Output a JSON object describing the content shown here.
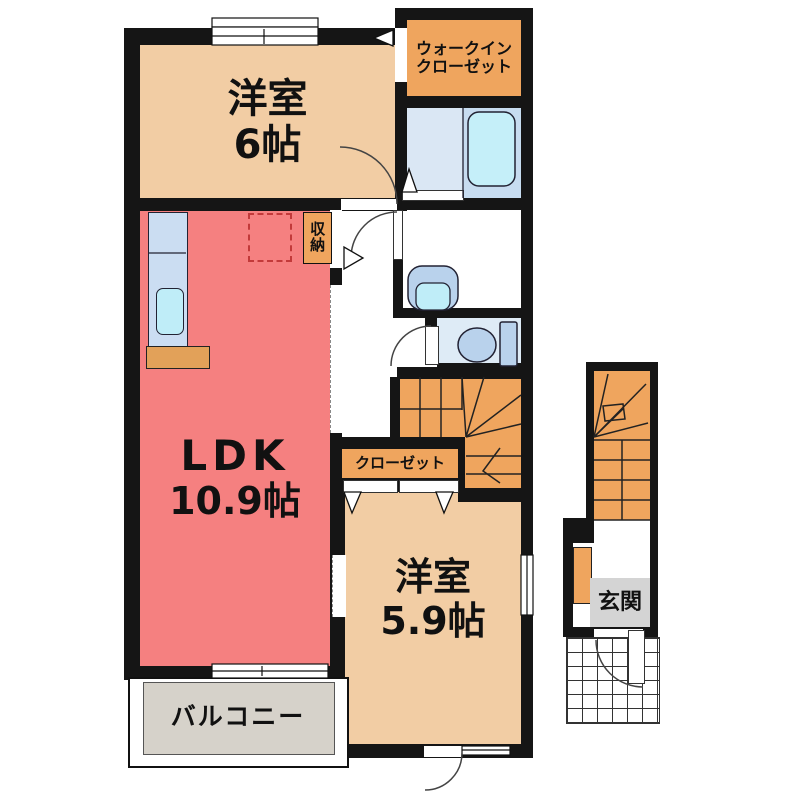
{
  "title": "apartment-floor-plan",
  "rooms": {
    "bedroom1": {
      "name": "洋室",
      "size": "6帖"
    },
    "wic": {
      "line1": "ウォークイン",
      "line2": "クローゼット"
    },
    "storage": {
      "label": "収納"
    },
    "ldk": {
      "name": "LDK",
      "size": "10.9帖"
    },
    "closet": {
      "label": "クローゼット"
    },
    "bedroom2": {
      "name": "洋室",
      "size": "5.9帖"
    },
    "balcony": {
      "label": "バルコニー"
    },
    "entrance": {
      "label": "玄関"
    }
  },
  "colors": {
    "wall": "#151515",
    "room_tan": "#F2CDA4",
    "ldk_salmon": "#F58080",
    "accent_orange": "#EFA55E",
    "bath_floor": "#DAE7F4",
    "bath_right": "#C7DCF0",
    "tub_blue": "#C5EFF9",
    "fixture_blue": "#B9D2EC",
    "sink_cyan": "#BFEDF8",
    "toilet_floor": "#DEEBF6",
    "kitchen_counter": "#CBDDF2",
    "counter_wood": "#E2A159",
    "balcony_gray": "#D6D2CA",
    "genkan_gray": "#D4D4D4",
    "fridge_dash": "#C23A3A"
  }
}
